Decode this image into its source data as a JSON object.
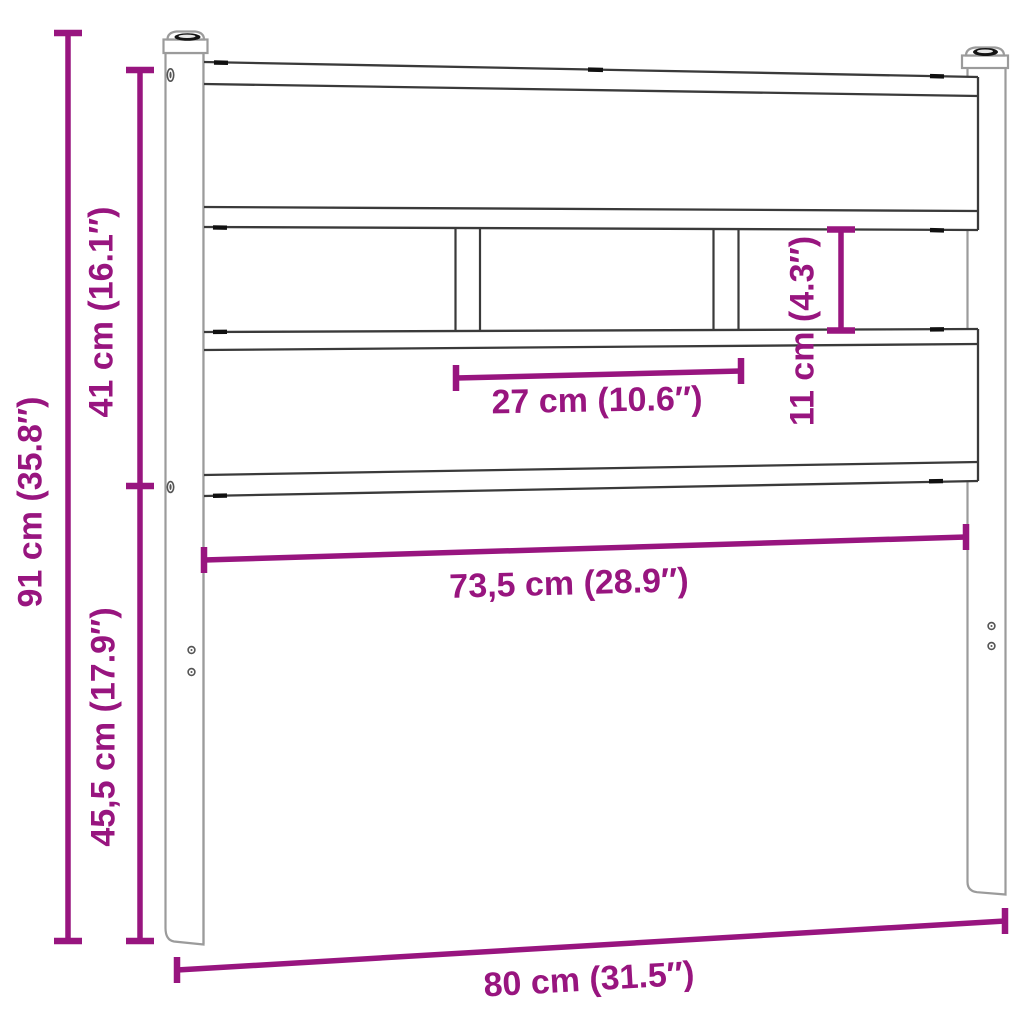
{
  "colors": {
    "dimension_accent": "#98157F",
    "outline_dark": "#3a3a3a",
    "outline_gray": "#9b9b9b",
    "hardware_dark": "#141414",
    "background": "#ffffff"
  },
  "dimensions": {
    "overall_height": {
      "label": "91 cm (35.8″)",
      "cm": 91,
      "inches": 35.8
    },
    "panel_height": {
      "label": "41 cm (16.1″)",
      "cm": 41,
      "inches": 16.1
    },
    "leg_height": {
      "label": "45,5 cm (17.9″)",
      "cm": 45.5,
      "inches": 17.9
    },
    "slat_opening_width": {
      "label": "27 cm (10.6″)",
      "cm": 27,
      "inches": 10.6
    },
    "slat_opening_height": {
      "label": "11 cm (4.3″)",
      "cm": 11,
      "inches": 4.3
    },
    "inner_width": {
      "label": "73,5 cm (28.9″)",
      "cm": 73.5,
      "inches": 28.9
    },
    "overall_width": {
      "label": "80 cm (31.5″)",
      "cm": 80,
      "inches": 31.5
    }
  }
}
